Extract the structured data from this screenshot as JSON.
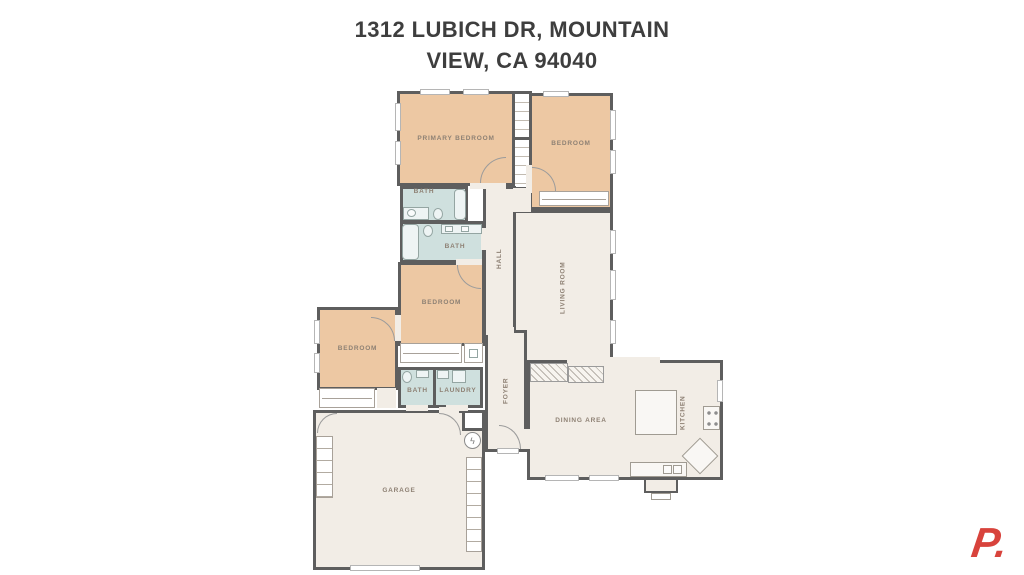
{
  "title": {
    "line1": "1312 LUBICH DR, MOUNTAIN",
    "line2": "VIEW, CA 94040"
  },
  "floorplan": {
    "rooms": [
      {
        "label": "PRIMARY BEDROOM"
      },
      {
        "label": "BEDROOM"
      },
      {
        "label": "BATH"
      },
      {
        "label": "BATH"
      },
      {
        "label": "HALL"
      },
      {
        "label": "LIVING ROOM"
      },
      {
        "label": "BEDROOM"
      },
      {
        "label": "BEDROOM"
      },
      {
        "label": "BATH"
      },
      {
        "label": "LAUNDRY"
      },
      {
        "label": "FOYER"
      },
      {
        "label": "DINING AREA"
      },
      {
        "label": "KITCHEN"
      },
      {
        "label": "GARAGE"
      }
    ]
  },
  "icons": {
    "water_heater": "ϟ"
  },
  "branding": {
    "logo_text": "P."
  },
  "colors": {
    "wall": "#5e5e5e",
    "bedroom_fill": "#edc8a3",
    "bath_fill": "#cfe0de",
    "floor_fill": "#f2ede6",
    "label": "#8e8174",
    "title_color": "#3e3e3e",
    "logo_red": "#d8433c"
  }
}
